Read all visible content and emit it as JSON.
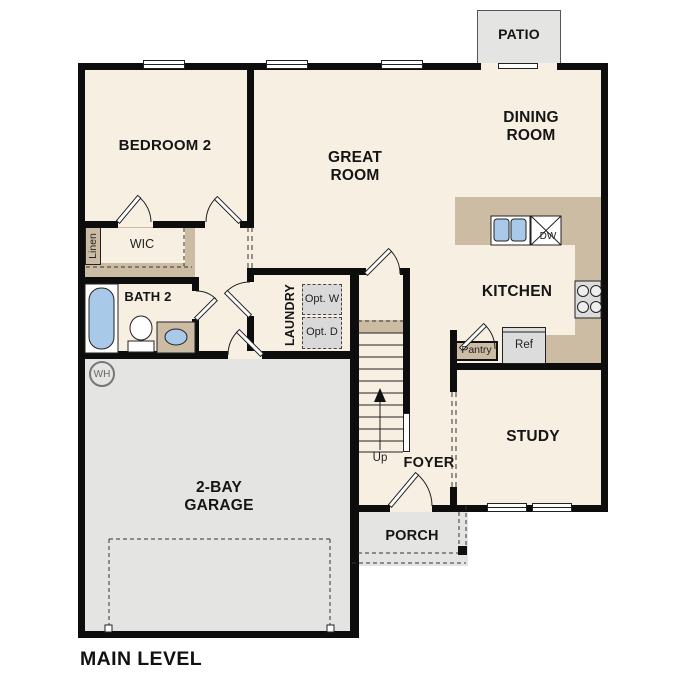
{
  "title": "MAIN LEVEL",
  "rooms": {
    "patio": "PATIO",
    "dining_room": "DINING ROOM",
    "great_room": "GREAT ROOM",
    "bedroom_2": "BEDROOM 2",
    "kitchen": "KITCHEN",
    "study": "STUDY",
    "foyer": "FOYER",
    "porch": "PORCH",
    "garage": "2-BAY GARAGE",
    "bath_2": "BATH 2",
    "laundry": "LAUNDRY",
    "wic": "WIC"
  },
  "features": {
    "linen": "Linen",
    "pantry": "Pantry",
    "refrigerator": "Ref",
    "dishwasher": "DW",
    "optional_washer": "Opt. W",
    "optional_dryer": "Opt. D",
    "stairs_up": "Up",
    "water_heater": "WH"
  },
  "colors": {
    "floor": "#f8efe3",
    "hard": "#e4e4e2",
    "counter": "#cbbca3",
    "fixture": "#a9c9e9",
    "wall": "#0d0d0d",
    "appliance": "#dcdcdc",
    "optbox": "#d9d9d9",
    "line": "#333333"
  }
}
